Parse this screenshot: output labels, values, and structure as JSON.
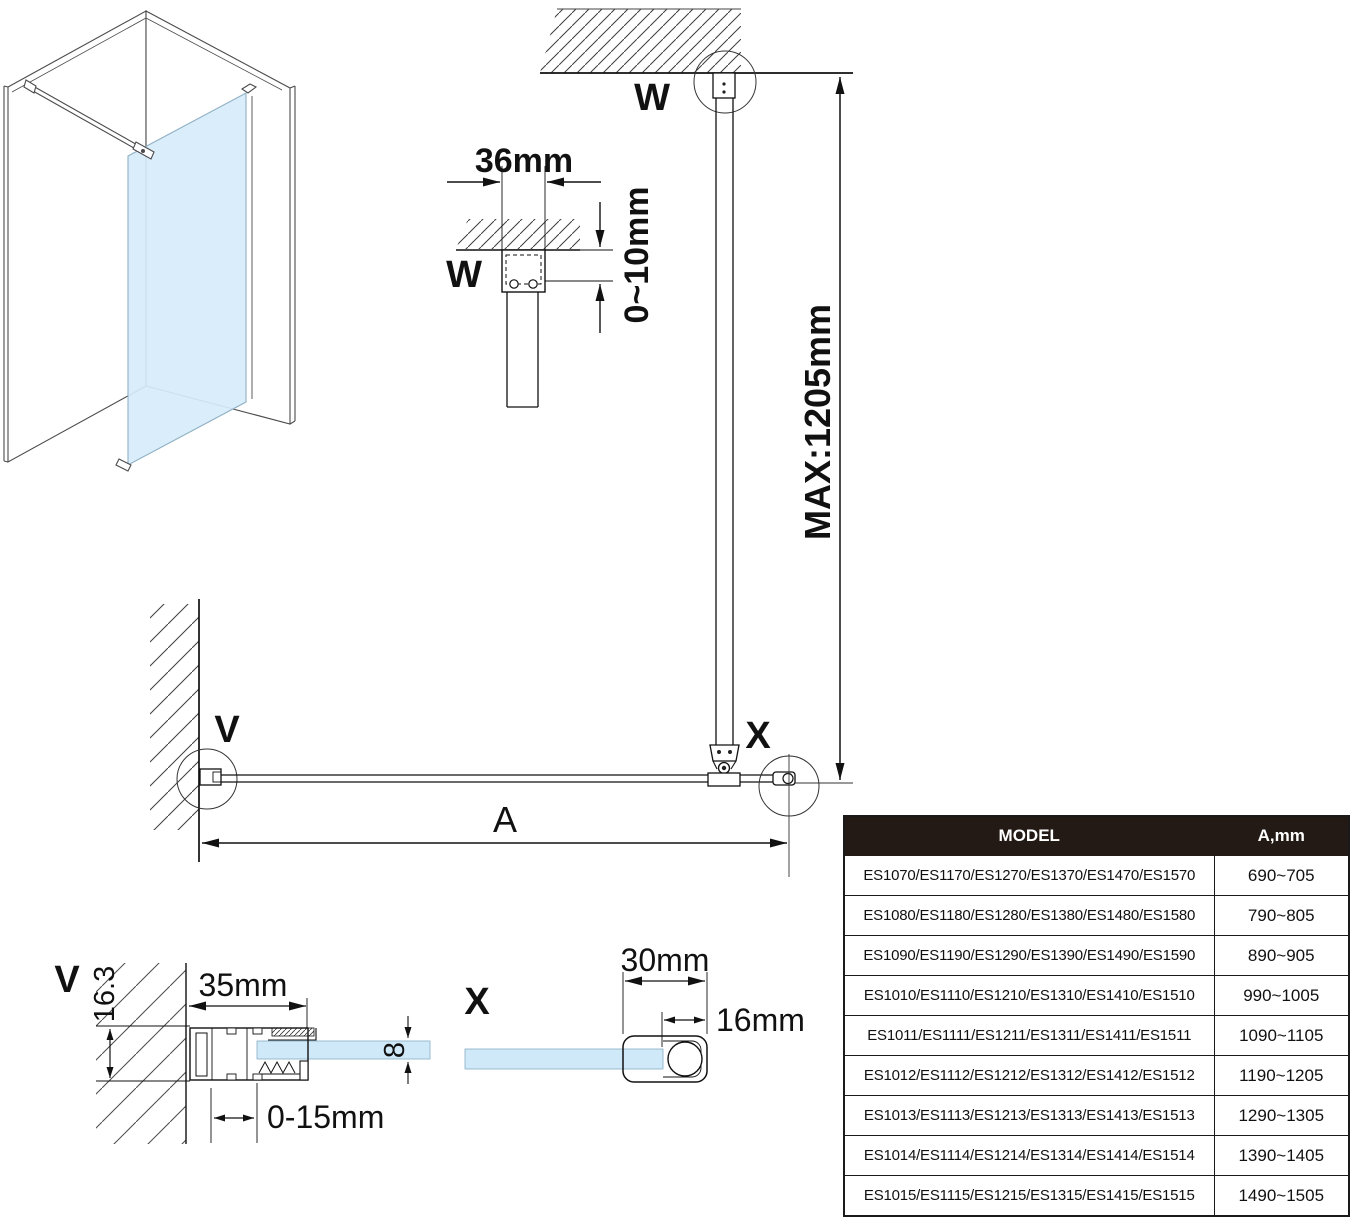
{
  "figure": {
    "top_detail": {
      "width_label": "36mm",
      "offset_label": "0~10mm",
      "bracket_label": "W"
    },
    "elevation": {
      "ceiling_detail_label": "W",
      "max_height_label": "MAX:1205mm",
      "wall_detail_label": "V",
      "corner_detail_label": "X",
      "width_label": "A"
    },
    "v_detail": {
      "title": "V",
      "profile_height": "16.3",
      "profile_width": "35mm",
      "insert_range": "0-15mm",
      "glass_thickness": "8"
    },
    "x_detail": {
      "title": "X",
      "profile_width": "30mm",
      "bar_width": "16mm"
    }
  },
  "colors": {
    "glass": "#cfe9f8",
    "line": "#111111",
    "table_header_bg": "#241a15",
    "table_header_text": "#ffffff"
  },
  "table": {
    "headers": [
      "MODEL",
      "A,mm"
    ],
    "rows": [
      {
        "model": "ES1070/ES1170/ES1270/ES1370/ES1470/ES1570",
        "a": "690~705"
      },
      {
        "model": "ES1080/ES1180/ES1280/ES1380/ES1480/ES1580",
        "a": "790~805"
      },
      {
        "model": "ES1090/ES1190/ES1290/ES1390/ES1490/ES1590",
        "a": "890~905"
      },
      {
        "model": "ES1010/ES1110/ES1210/ES1310/ES1410/ES1510",
        "a": "990~1005"
      },
      {
        "model": "ES1011/ES1111/ES1211/ES1311/ES1411/ES1511",
        "a": "1090~1105"
      },
      {
        "model": "ES1012/ES1112/ES1212/ES1312/ES1412/ES1512",
        "a": "1190~1205"
      },
      {
        "model": "ES1013/ES1113/ES1213/ES1313/ES1413/ES1513",
        "a": "1290~1305"
      },
      {
        "model": "ES1014/ES1114/ES1214/ES1314/ES1414/ES1514",
        "a": "1390~1405"
      },
      {
        "model": "ES1015/ES1115/ES1215/ES1315/ES1415/ES1515",
        "a": "1490~1505"
      }
    ]
  }
}
